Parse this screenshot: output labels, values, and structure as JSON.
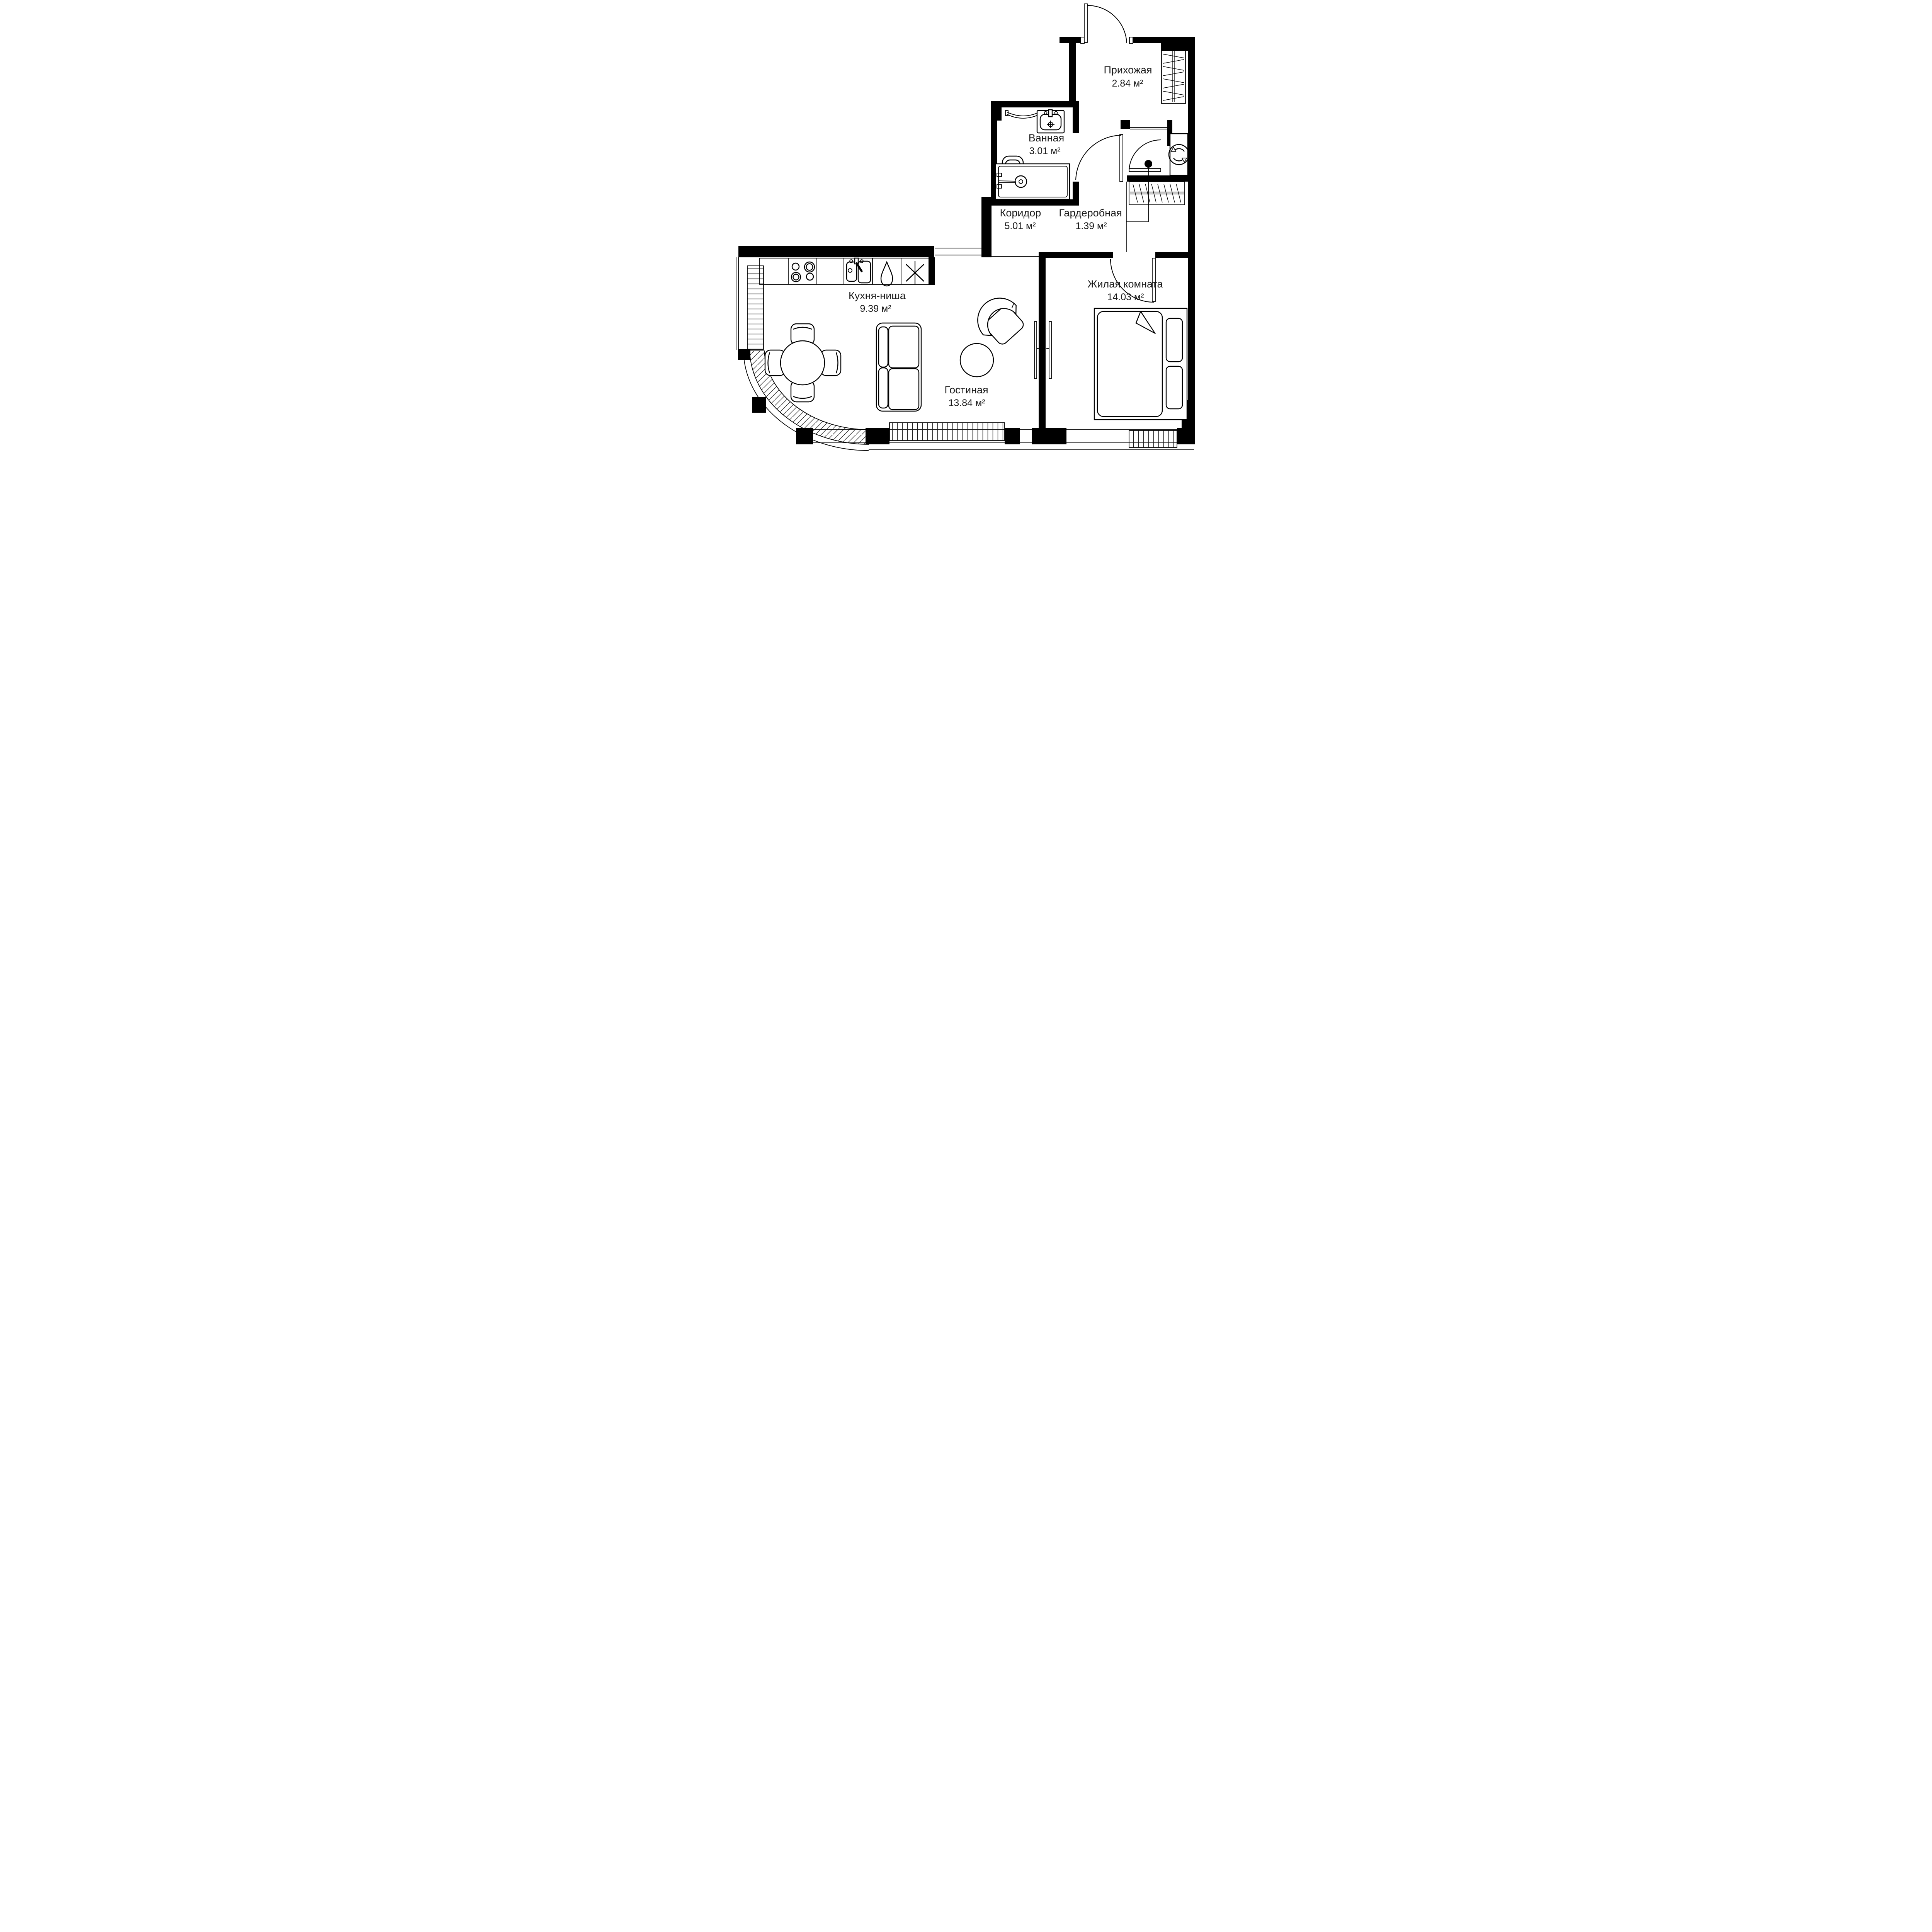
{
  "plan": {
    "background": "#ffffff",
    "wall_color": "#000000",
    "line_color": "#000000",
    "text_color": "#1a1a1a",
    "rooms": [
      {
        "key": "hallway",
        "name": "Прихожая",
        "area": "2.84 м²"
      },
      {
        "key": "bathroom",
        "name": "Ванная",
        "area": "3.01 м²"
      },
      {
        "key": "corridor",
        "name": "Коридор",
        "area": "5.01 м²"
      },
      {
        "key": "wardrobe",
        "name": "Гардеробная",
        "area": "1.39 м²"
      },
      {
        "key": "kitchen_niche",
        "name": "Кухня-ниша",
        "area": "9.39 м²"
      },
      {
        "key": "living",
        "name": "Гостиная",
        "area": "13.84 м²"
      },
      {
        "key": "bedroom",
        "name": "Жилая комната",
        "area": "14.03 м²"
      }
    ],
    "fixtures": [
      "entrance-door",
      "coat-rack",
      "wash-basin",
      "toilet",
      "towel-rail",
      "bathtub",
      "washing-machine",
      "wardrobe-rail",
      "kitchen-counter",
      "cooktop",
      "kitchen-sink",
      "dishwasher-droplet",
      "fridge-snowflake",
      "dining-table",
      "dining-chairs",
      "sofa",
      "armchair",
      "coffee-table",
      "sliding-partition",
      "double-bed",
      "pillows",
      "radiators",
      "curved-glass-wall"
    ]
  }
}
